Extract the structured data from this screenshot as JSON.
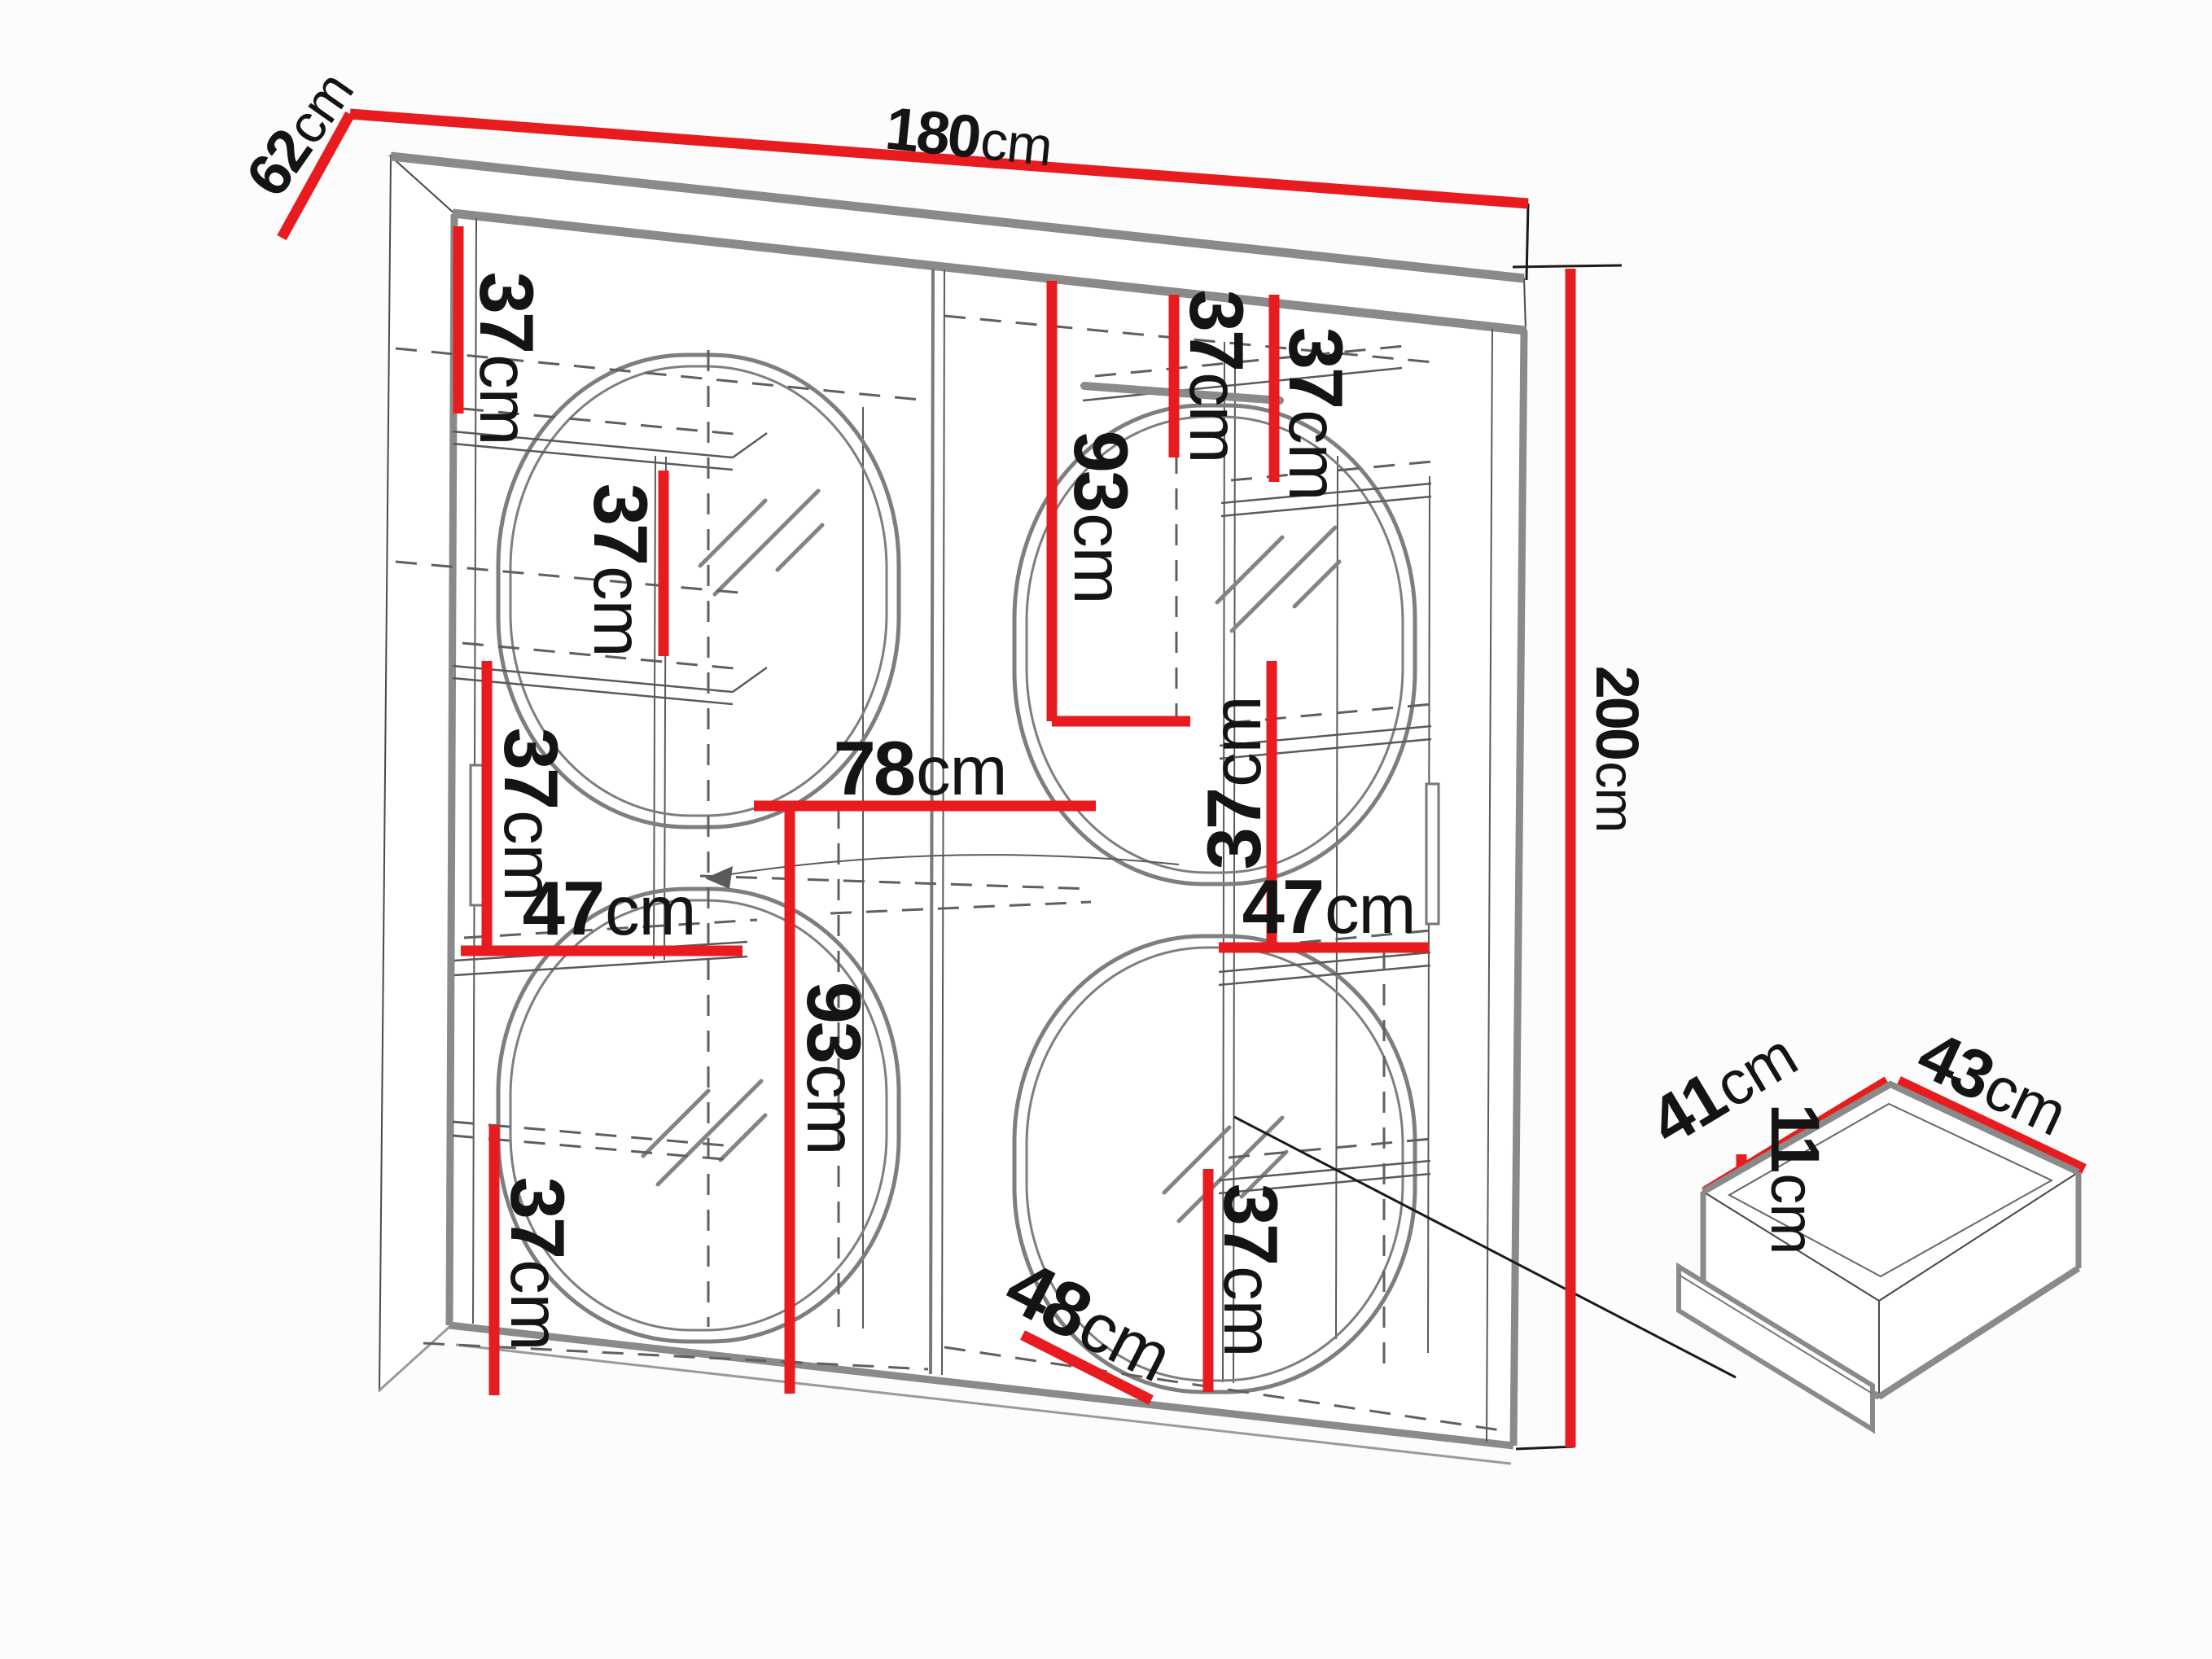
{
  "diagram": {
    "kind": "furniture dimension diagram",
    "subject": "two-door sliding wardrobe with mirrors and drawer detail"
  },
  "colors": {
    "dimension_red": "#e81c1e",
    "outline_grey": "#8a8a8a",
    "text_black": "#141414",
    "background": "#fcfcfc"
  },
  "labels": [
    {
      "id": "depth",
      "value": "62",
      "unit": "cm"
    },
    {
      "id": "width",
      "value": "180",
      "unit": "cm"
    },
    {
      "id": "height",
      "value": "200",
      "unit": "cm"
    },
    {
      "id": "shelf-top-left",
      "value": "37",
      "unit": "cm"
    },
    {
      "id": "shelf-left-inner",
      "value": "37",
      "unit": "cm"
    },
    {
      "id": "shelf-left-middle",
      "value": "37",
      "unit": "cm"
    },
    {
      "id": "shelf-left-width",
      "value": "47",
      "unit": "cm"
    },
    {
      "id": "half-width",
      "value": "78",
      "unit": "cm"
    },
    {
      "id": "lower-left-height",
      "value": "93",
      "unit": "cm"
    },
    {
      "id": "shelf-bottom-left",
      "value": "37",
      "unit": "cm"
    },
    {
      "id": "upper-right-height",
      "value": "93",
      "unit": "cm"
    },
    {
      "id": "shelf-top-right-a",
      "value": "37",
      "unit": "cm"
    },
    {
      "id": "shelf-top-right-b",
      "value": "37",
      "unit": "cm"
    },
    {
      "id": "shelf-right-middle",
      "value": "37",
      "unit": "cm"
    },
    {
      "id": "shelf-right-width",
      "value": "47",
      "unit": "cm"
    },
    {
      "id": "shelf-bottom-right",
      "value": "37",
      "unit": "cm"
    },
    {
      "id": "bottom-depth",
      "value": "48",
      "unit": "cm"
    },
    {
      "id": "drawer-depth",
      "value": "41",
      "unit": "cm"
    },
    {
      "id": "drawer-width",
      "value": "43",
      "unit": "cm"
    },
    {
      "id": "drawer-height",
      "value": "11",
      "unit": "cm"
    }
  ]
}
